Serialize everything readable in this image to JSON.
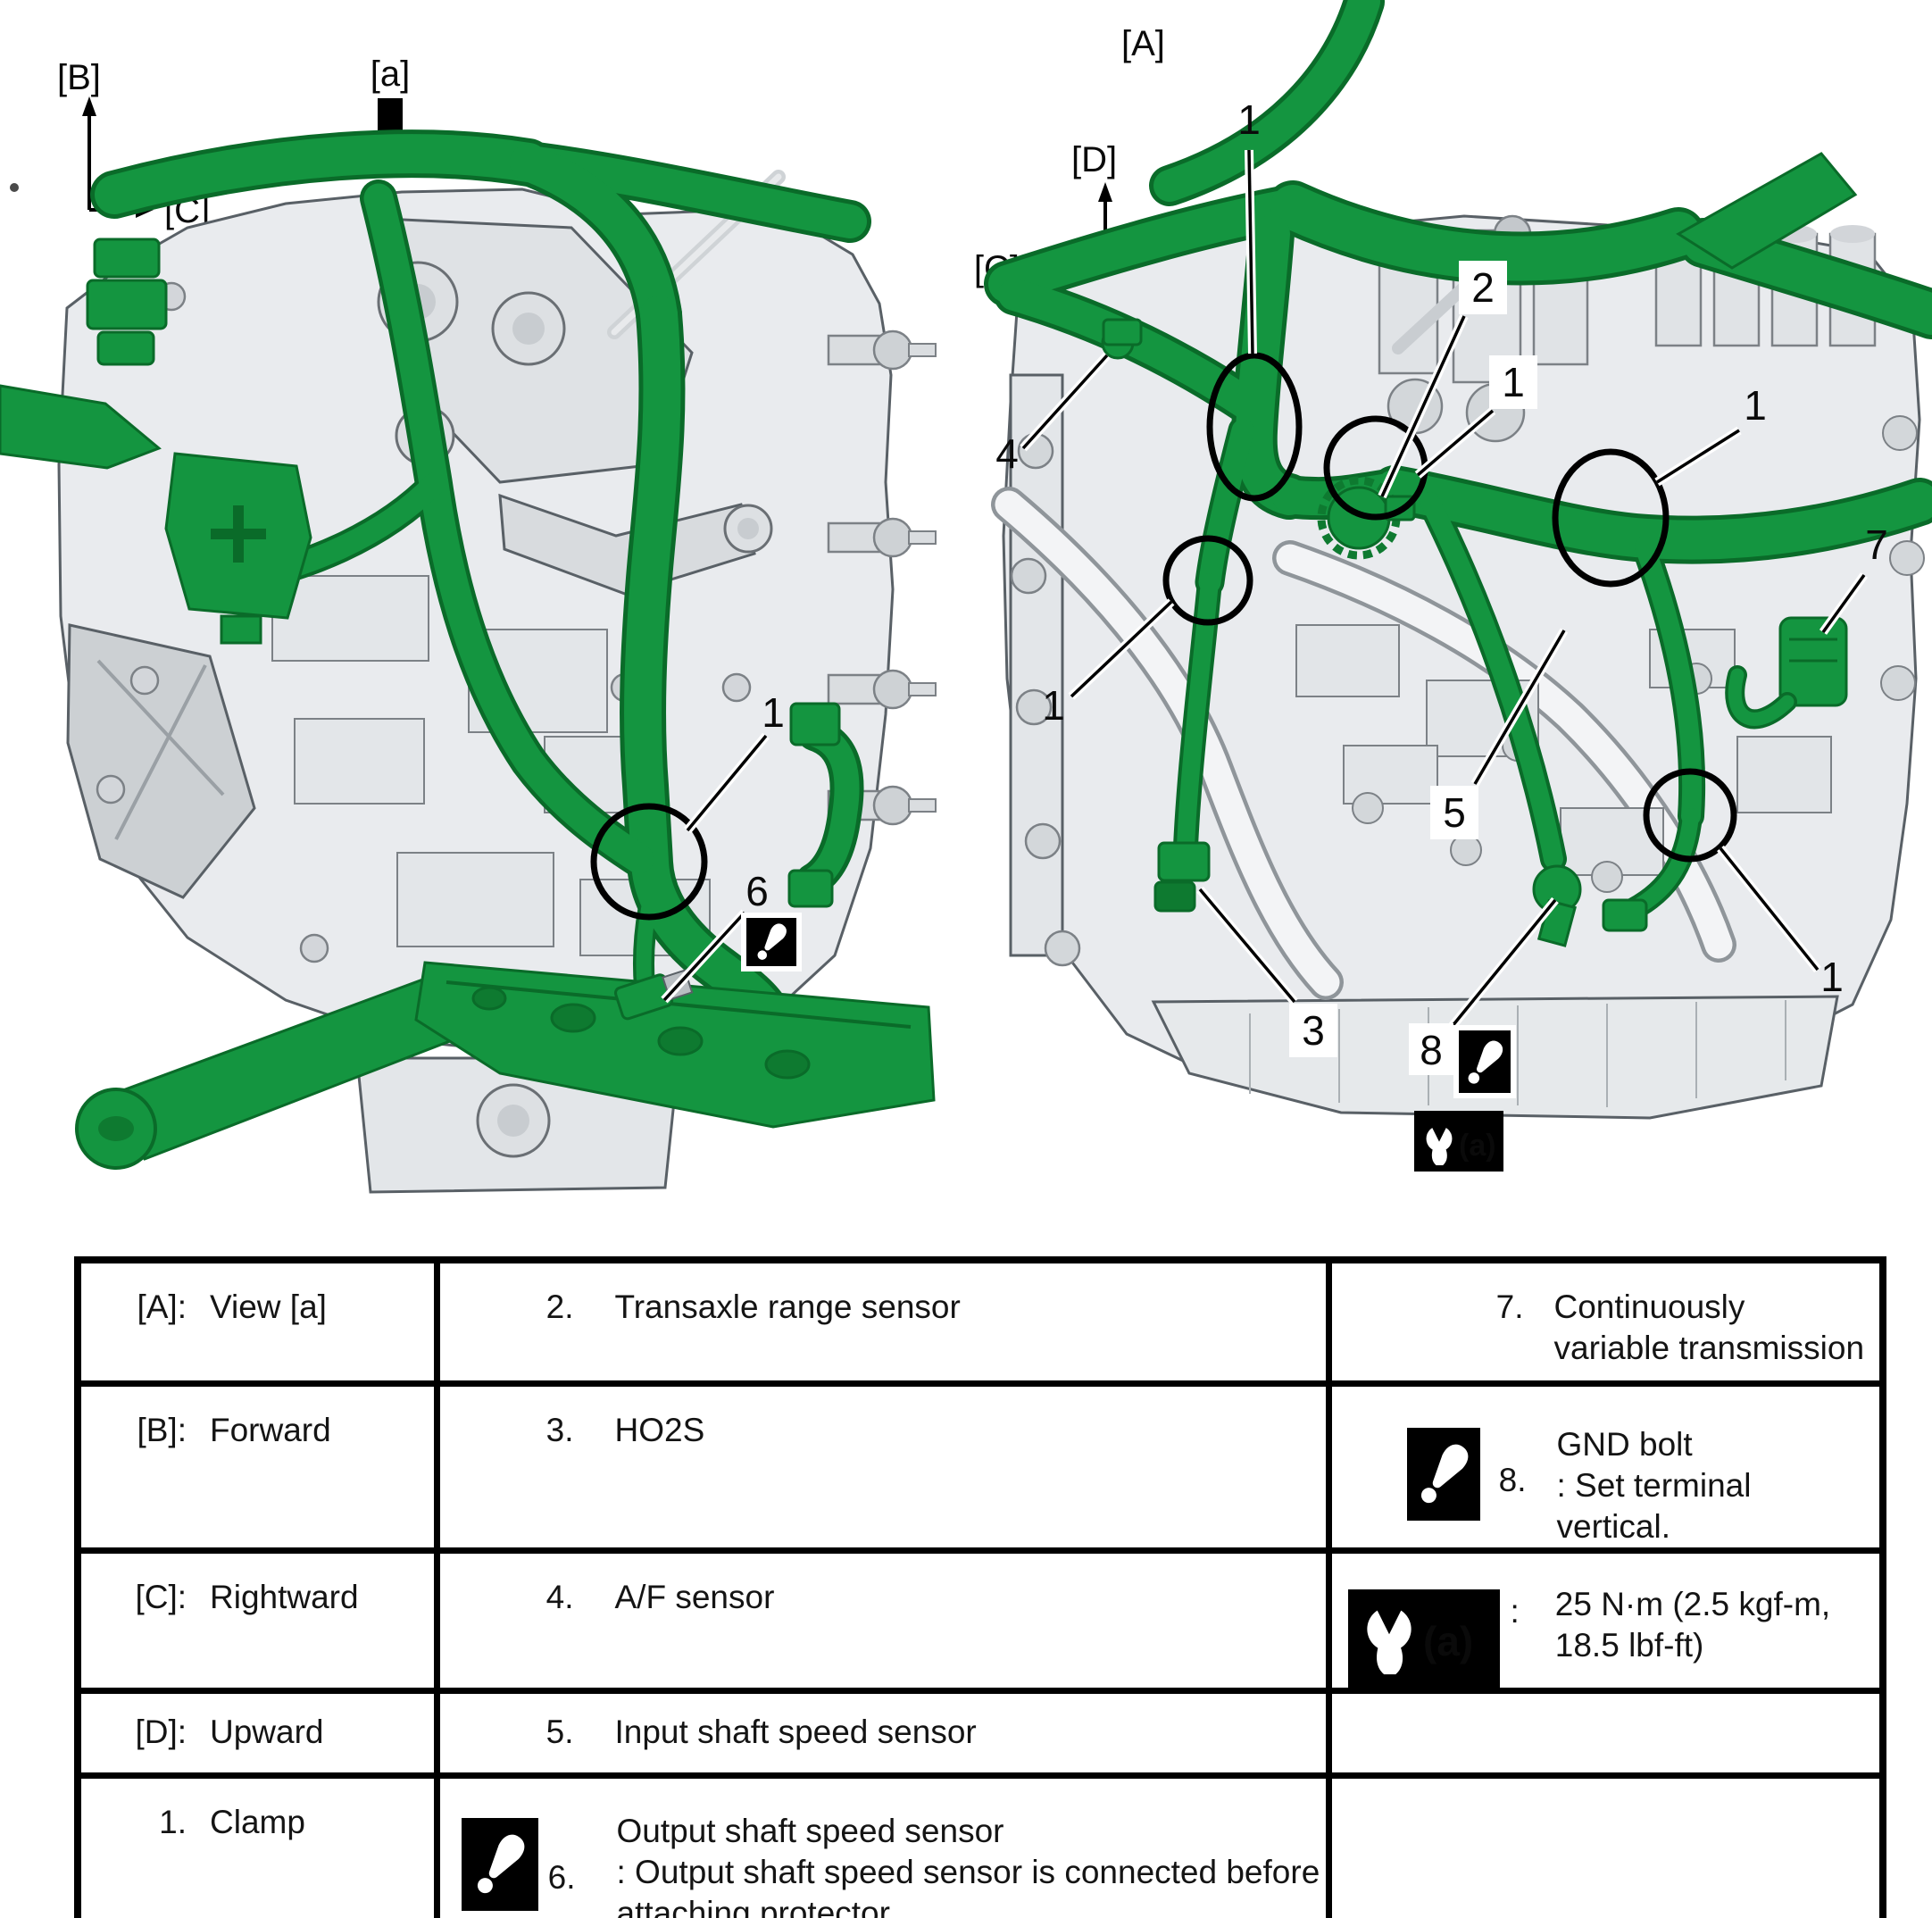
{
  "figure": {
    "left_view": {
      "axis_up": "[B]",
      "axis_right": "[C]",
      "view_label": "[a]",
      "callouts": {
        "clamp": "1",
        "output_sensor": "6"
      }
    },
    "right_view": {
      "view_title": "[A]",
      "axis_up": "[D]",
      "axis_left": "[C]",
      "axis_down": "[B]",
      "callouts": {
        "top_clamp": "1",
        "range_sensor": "2",
        "mid_clamp": "1",
        "right_clamp": "1",
        "af_sensor": "4",
        "cvt": "7",
        "input_sensor": "5",
        "left_clamp": "1",
        "ho2s": "3",
        "gnd_bolt": "8",
        "bottom_clamp": "1"
      },
      "torque_ref": "(a)"
    }
  },
  "legend": {
    "rows": [
      {
        "key": "[A]:",
        "key_val": "View [a]",
        "mid_num": "2.",
        "mid_text": "Transaxle range sensor",
        "right_num": "7.",
        "right_text": "Continuously variable transmission"
      },
      {
        "key": "[B]:",
        "key_val": "Forward",
        "mid_num": "3.",
        "mid_text": "HO2S",
        "right_num": "8.",
        "right_text": "GND bolt",
        "right_note": ": Set terminal vertical."
      },
      {
        "key": "[C]:",
        "key_val": "Rightward",
        "mid_num": "4.",
        "mid_text": "A/F sensor",
        "right_icon_label": "(a)",
        "right_sep": ":",
        "right_text": "25 N·m (2.5 kgf-m, 18.5 lbf-ft)"
      },
      {
        "key": "[D]:",
        "key_val": "Upward",
        "mid_num": "5.",
        "mid_text": "Input shaft speed sensor"
      },
      {
        "key": "1.",
        "key_val": "Clamp",
        "mid_num": "6.",
        "mid_text": "Output shaft speed sensor",
        "mid_note": ": Output shaft speed sensor is connected before attaching protector."
      }
    ]
  },
  "colors": {
    "harness_green": "#149540",
    "harness_dark": "#0a6b29",
    "callout_black": "#000000",
    "body_gray": "#e9ebee"
  }
}
